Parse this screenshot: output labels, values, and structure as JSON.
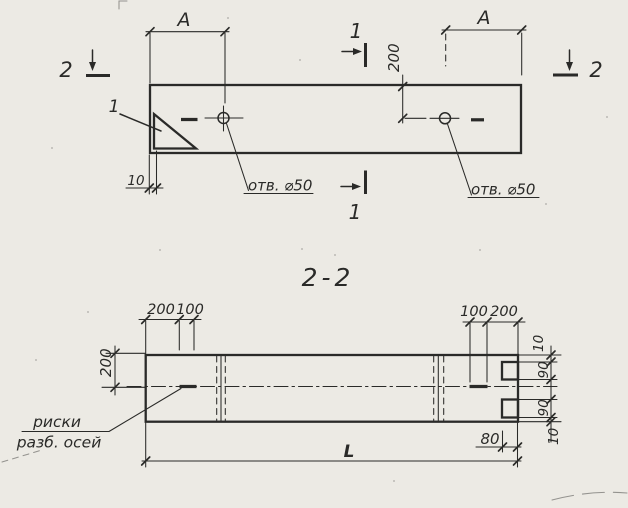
{
  "meta": {
    "description": "Scanned engineering drawing: plan of a beam with two holes and section 2-2"
  },
  "colors": {
    "paper": "#eceae4",
    "ink": "#2a2a28"
  },
  "top_view": {
    "dim_a_left": "A",
    "dim_a_right": "A",
    "dim_hole_offset": "200",
    "dim_end_wall": "10",
    "hole_1_label": "отв. ⌀50",
    "hole_2_label": "отв. ⌀50",
    "detail_mark": "1",
    "section_mark_1_top": "1",
    "section_mark_1_bottom": "1",
    "section_mark_2_left": "2",
    "section_mark_2_right": "2"
  },
  "section_view": {
    "title": "2-2",
    "dim_top_left_200": "200",
    "dim_top_left_100": "100",
    "dim_top_right_100": "100",
    "dim_top_right_200": "200",
    "dim_left_height": "200",
    "dim_right_top_10": "10",
    "dim_right_top_90": "90",
    "dim_right_bottom_90": "90",
    "dim_right_bottom_10": "10",
    "dim_notch_depth": "80",
    "dim_total_length": "L",
    "axis_note_line1": "риски",
    "axis_note_line2": "разб. осей"
  }
}
